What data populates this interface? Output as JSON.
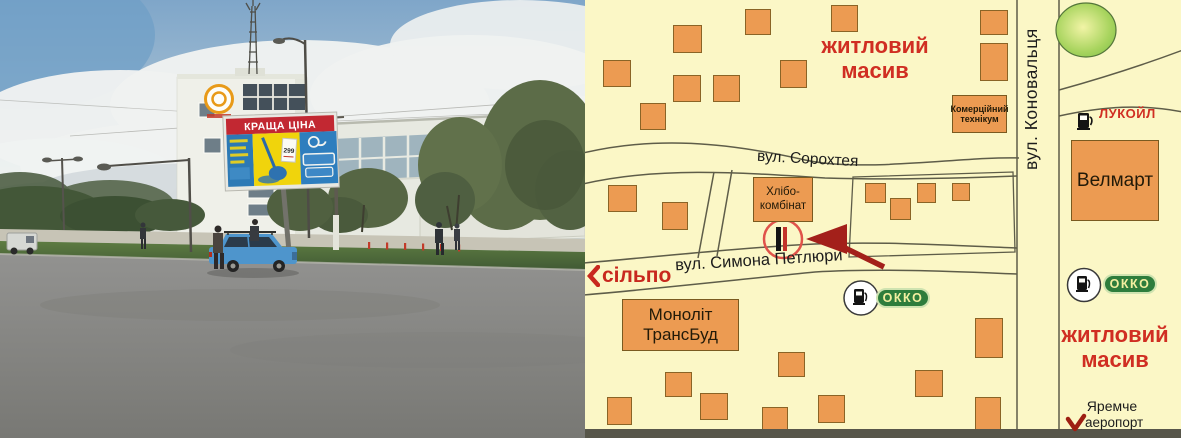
{
  "window": {
    "description": "billboard location sheet: street photo with billboard and schematic town map"
  },
  "colors": {
    "map_background": "#FBF7C6",
    "building_fill": "#EC9B52",
    "building_outline": "#8A6426",
    "road_line": "#5E5D49",
    "label_red": "#D02E22",
    "okko_green": "#2E7D3C",
    "okko_text": "#F2EFA0",
    "marker_red": "#E0534A",
    "arrow_red": "#A3201A",
    "billboard_header_red": "#C22832",
    "billboard_yellow": "#F0D40C",
    "billboard_blue": "#2E7EBE",
    "car_blue": "#4E95CC"
  },
  "photo": {
    "billboard": {
      "header": "КРАЩА ЦІНА",
      "price": "299"
    }
  },
  "map": {
    "streets": {
      "konovaltsia": "вул. Коновальця",
      "sorokhteia": "вул. Сорохтея",
      "petliury": "вул. Симона Петлюри"
    },
    "areas": {
      "residential_top": "житловий\nмасив",
      "residential_bottom": "житловий\nмасив"
    },
    "places": {
      "velmart": "Велмарт",
      "college": "Комерційний\nтехнікум",
      "khlibokombinat": "Хлібо-\nкомбінат",
      "monolit": "Моноліт\nТрансБуд",
      "silpo": "сільпо",
      "lukoil": "ЛУКОЙЛ",
      "okko": "ОККО",
      "yaremche": "Яремче",
      "airport": "аеропорт"
    },
    "icons": {
      "silpo_chevron": "chevron-left",
      "gas_pump": "gas-pump",
      "airport_arrow": "curved-red-arrow",
      "billboard_marker": "red-circle-billboard"
    }
  }
}
